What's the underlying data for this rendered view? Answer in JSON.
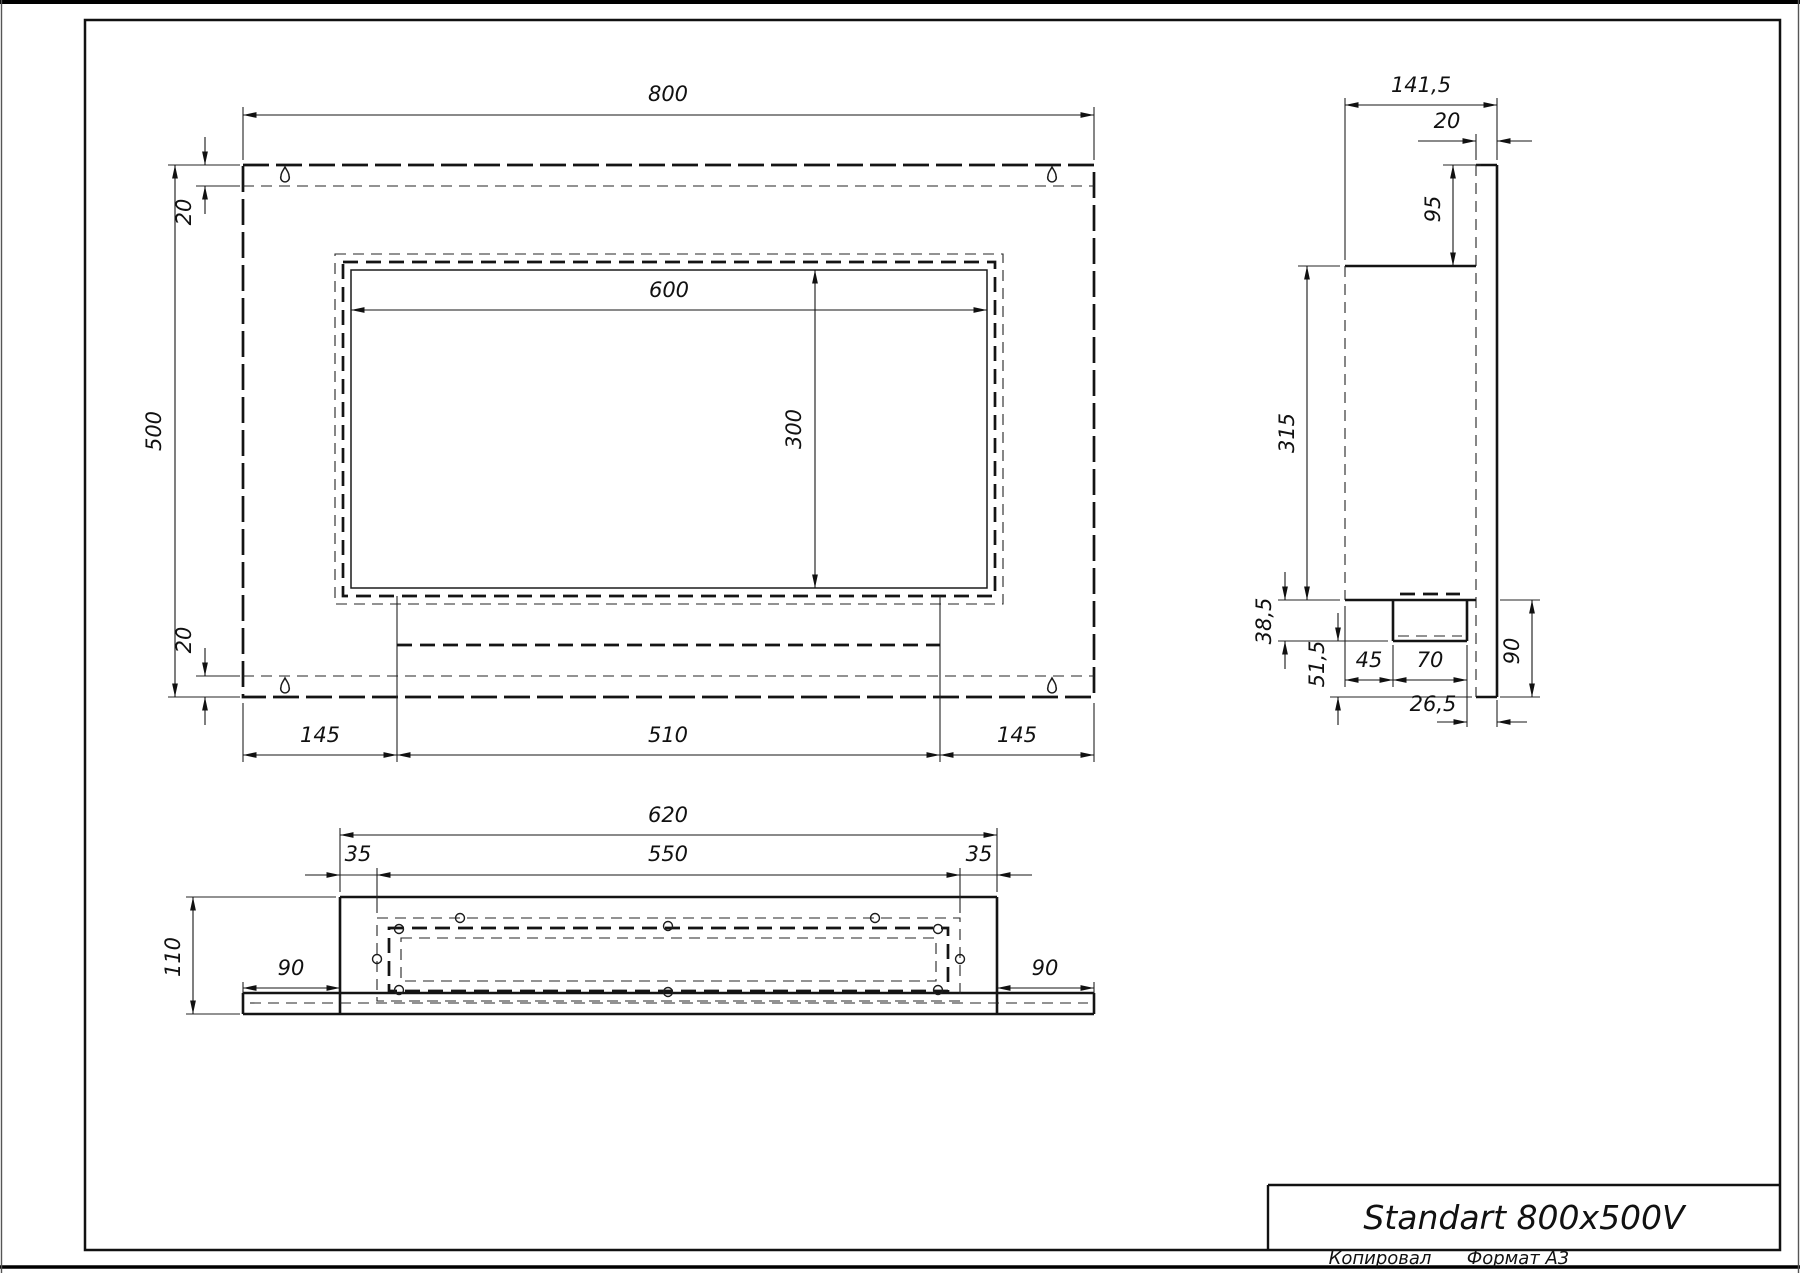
{
  "title_block": {
    "title": "Standart 800x500V",
    "copied_by": "Копировал",
    "format": "Формат А3"
  },
  "front_view": {
    "dims": {
      "width": "800",
      "height": "500",
      "top_inset": "20",
      "bottom_inset": "20",
      "opening_width": "600",
      "opening_height": "300",
      "bottom_left": "145",
      "bottom_middle": "510",
      "bottom_right": "145"
    }
  },
  "side_view": {
    "dims": {
      "overall_width": "141,5",
      "plate_thickness": "20",
      "top_offset": "95",
      "body_height": "315",
      "tray_depth": "38,5",
      "lower_gap": "51,5",
      "tray_inset": "45",
      "tray_width": "70",
      "lower_height": "90",
      "bottom_inset": "26,5"
    }
  },
  "bottom_view": {
    "dims": {
      "overall_width": "620",
      "inset_left": "35",
      "inner_width": "550",
      "inset_right": "35",
      "depth": "110",
      "flange_left": "90",
      "flange_right": "90"
    }
  }
}
